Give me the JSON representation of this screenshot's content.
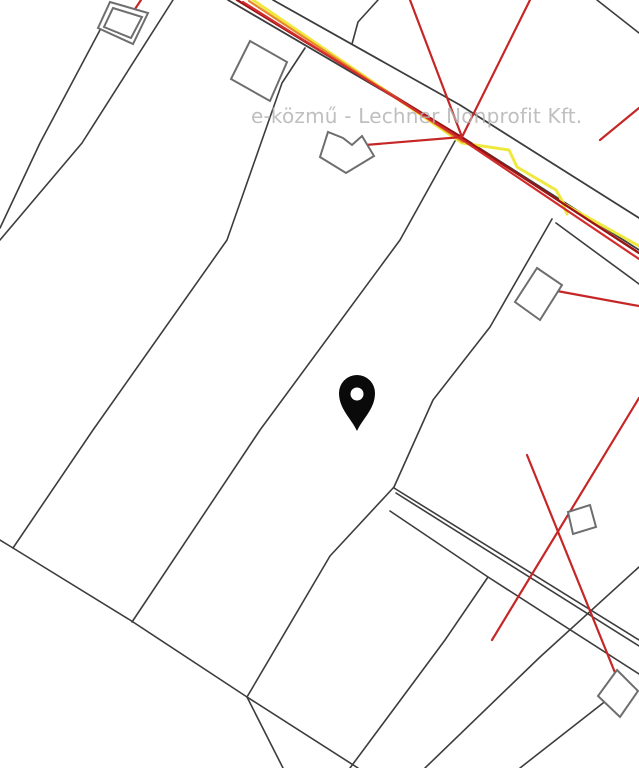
{
  "meta": {
    "type": "utility-cadastral-map",
    "width": 639,
    "height": 768,
    "background": "#ffffff"
  },
  "watermark": {
    "text": "e-közmű - Lechner Nonprofit Kft.",
    "color": "#b2b2b2",
    "x": 251,
    "y": 104,
    "font_size": 20
  },
  "palette": {
    "parcel_line": "#3d3d3d",
    "building_outline": "#6e6e6e",
    "electric_red": "#c62626",
    "electric_dark_red": "#9b1313",
    "electric_orange": "#e8862c",
    "gas_yellow": "#efe93f",
    "pin_black": "#0a0a0a"
  },
  "layers": {
    "line_groups": [
      {
        "name": "parcel-boundary-lines",
        "color": "#3d3d3d",
        "width": 1.6,
        "paths": [
          [
            [
              173,
              0
            ],
            [
              82,
              143
            ],
            [
              0,
              240
            ]
          ],
          [
            [
              100,
              30
            ],
            [
              40,
              143
            ],
            [
              0,
              228
            ]
          ],
          [
            [
              378,
              0
            ],
            [
              358,
              22
            ],
            [
              352,
              44
            ]
          ],
          [
            [
              597,
              0
            ],
            [
              639,
              33
            ]
          ],
          [
            [
              305,
              48
            ],
            [
              282,
              83
            ],
            [
              227,
              240
            ],
            [
              93,
              430
            ],
            [
              13,
              548
            ]
          ],
          [
            [
              455,
              141
            ],
            [
              400,
              240
            ],
            [
              260,
              430
            ],
            [
              132,
              622
            ]
          ],
          [
            [
              552,
              219
            ],
            [
              490,
              327
            ],
            [
              433,
              400
            ],
            [
              394,
              487
            ]
          ],
          [
            [
              556,
              223
            ],
            [
              639,
              284
            ]
          ],
          [
            [
              0,
              540
            ],
            [
              13,
              548
            ],
            [
              130,
              620
            ],
            [
              247,
              697
            ],
            [
              358,
              768
            ]
          ],
          [
            [
              247,
              697
            ],
            [
              283,
              768
            ]
          ],
          [
            [
              394,
              487
            ],
            [
              330,
              556
            ],
            [
              247,
              697
            ]
          ],
          [
            [
              394,
              488
            ],
            [
              639,
              640
            ]
          ],
          [
            [
              396,
              493
            ],
            [
              639,
              646
            ]
          ],
          [
            [
              390,
              511
            ],
            [
              488,
              577
            ],
            [
              639,
              674
            ]
          ],
          [
            [
              488,
              577
            ],
            [
              445,
              640
            ],
            [
              350,
              768
            ]
          ],
          [
            [
              639,
              567
            ],
            [
              540,
              657
            ],
            [
              425,
              768
            ]
          ],
          [
            [
              621,
              689
            ],
            [
              520,
              768
            ]
          ]
        ]
      },
      {
        "name": "road-edge-lines",
        "color": "#3d3d3d",
        "width": 1.8,
        "paths": [
          [
            [
              228,
              0
            ],
            [
              462,
              137
            ],
            [
              639,
              250
            ]
          ],
          [
            [
              273,
              0
            ],
            [
              460,
              105
            ],
            [
              639,
              218
            ]
          ]
        ]
      },
      {
        "name": "gas-pipeline-yellow",
        "color": "#efe93f",
        "width": 3,
        "paths": [
          [
            [
              253,
              0
            ],
            [
              462,
              143
            ],
            [
              509,
              150
            ],
            [
              517,
              167
            ],
            [
              556,
              190
            ],
            [
              564,
              204
            ],
            [
              639,
              246
            ]
          ],
          [
            [
              560,
              197
            ],
            [
              567,
              214
            ]
          ]
        ]
      },
      {
        "name": "electric-line-dark-red",
        "color": "#9b1313",
        "width": 2.4,
        "paths": [
          [
            [
              237,
              0
            ],
            [
              461,
              137
            ],
            [
              639,
              253
            ]
          ]
        ]
      },
      {
        "name": "electric-line-orange",
        "color": "#e8862c",
        "width": 2.2,
        "paths": [
          [
            [
              249,
              1
            ],
            [
              463,
              142
            ]
          ]
        ]
      },
      {
        "name": "electric-line-red-along-road",
        "color": "#d22d2d",
        "width": 2.2,
        "paths": [
          [
            [
              243,
              2
            ],
            [
              464,
              141
            ],
            [
              639,
              259
            ]
          ]
        ]
      },
      {
        "name": "electric-service-lines-red",
        "color": "#c62626",
        "width": 2.2,
        "paths": [
          [
            [
              410,
              0
            ],
            [
              462,
              137
            ]
          ],
          [
            [
              530,
              0
            ],
            [
              462,
              137
            ]
          ],
          [
            [
              462,
              137
            ],
            [
              353,
              146
            ]
          ],
          [
            [
              639,
              108
            ],
            [
              600,
              140
            ]
          ],
          [
            [
              639,
              306
            ],
            [
              557,
              291
            ]
          ],
          [
            [
              639,
              398
            ],
            [
              492,
              640
            ]
          ],
          [
            [
              527,
              455
            ],
            [
              622,
              690
            ]
          ],
          [
            [
              125,
              24
            ],
            [
              141,
              0
            ]
          ]
        ]
      }
    ],
    "buildings": {
      "stroke": "#6e6e6e",
      "width": 2,
      "fill": "#ffffff",
      "polygons": [
        {
          "name": "building-top-left-outer",
          "points": [
            [
              110,
              2
            ],
            [
              148,
              13
            ],
            [
              133,
              44
            ],
            [
              98,
              28
            ]
          ]
        },
        {
          "name": "building-top-left-inner",
          "points": [
            [
              113,
              8
            ],
            [
              142,
              17
            ],
            [
              131,
              38
            ],
            [
              104,
              27
            ]
          ]
        },
        {
          "name": "building-upper-mid",
          "points": [
            [
              250,
              41
            ],
            [
              287,
              62
            ],
            [
              270,
              101
            ],
            [
              231,
              79
            ]
          ]
        },
        {
          "name": "building-notched-by-road",
          "points": [
            [
              320,
              157
            ],
            [
              328,
              132
            ],
            [
              343,
              138
            ],
            [
              352,
              145
            ],
            [
              362,
              136
            ],
            [
              374,
              156
            ],
            [
              346,
              173
            ]
          ]
        },
        {
          "name": "building-right-mid",
          "points": [
            [
              537,
              268
            ],
            [
              562,
              285
            ],
            [
              540,
              320
            ],
            [
              515,
              302
            ]
          ]
        },
        {
          "name": "building-small-lower-right",
          "points": [
            [
              568,
              512
            ],
            [
              590,
              505
            ],
            [
              596,
              527
            ],
            [
              573,
              534
            ]
          ]
        },
        {
          "name": "building-bottom-right",
          "points": [
            [
              617,
              670
            ],
            [
              638,
              691
            ],
            [
              620,
              717
            ],
            [
              598,
              696
            ]
          ]
        }
      ]
    },
    "pin": {
      "color": "#0a0a0a",
      "head_cx": 357,
      "head_cy": 393,
      "head_r": 18,
      "tip_x": 357,
      "tip_y": 431,
      "hole_r": 6.5,
      "hole_color": "#ffffff"
    }
  }
}
